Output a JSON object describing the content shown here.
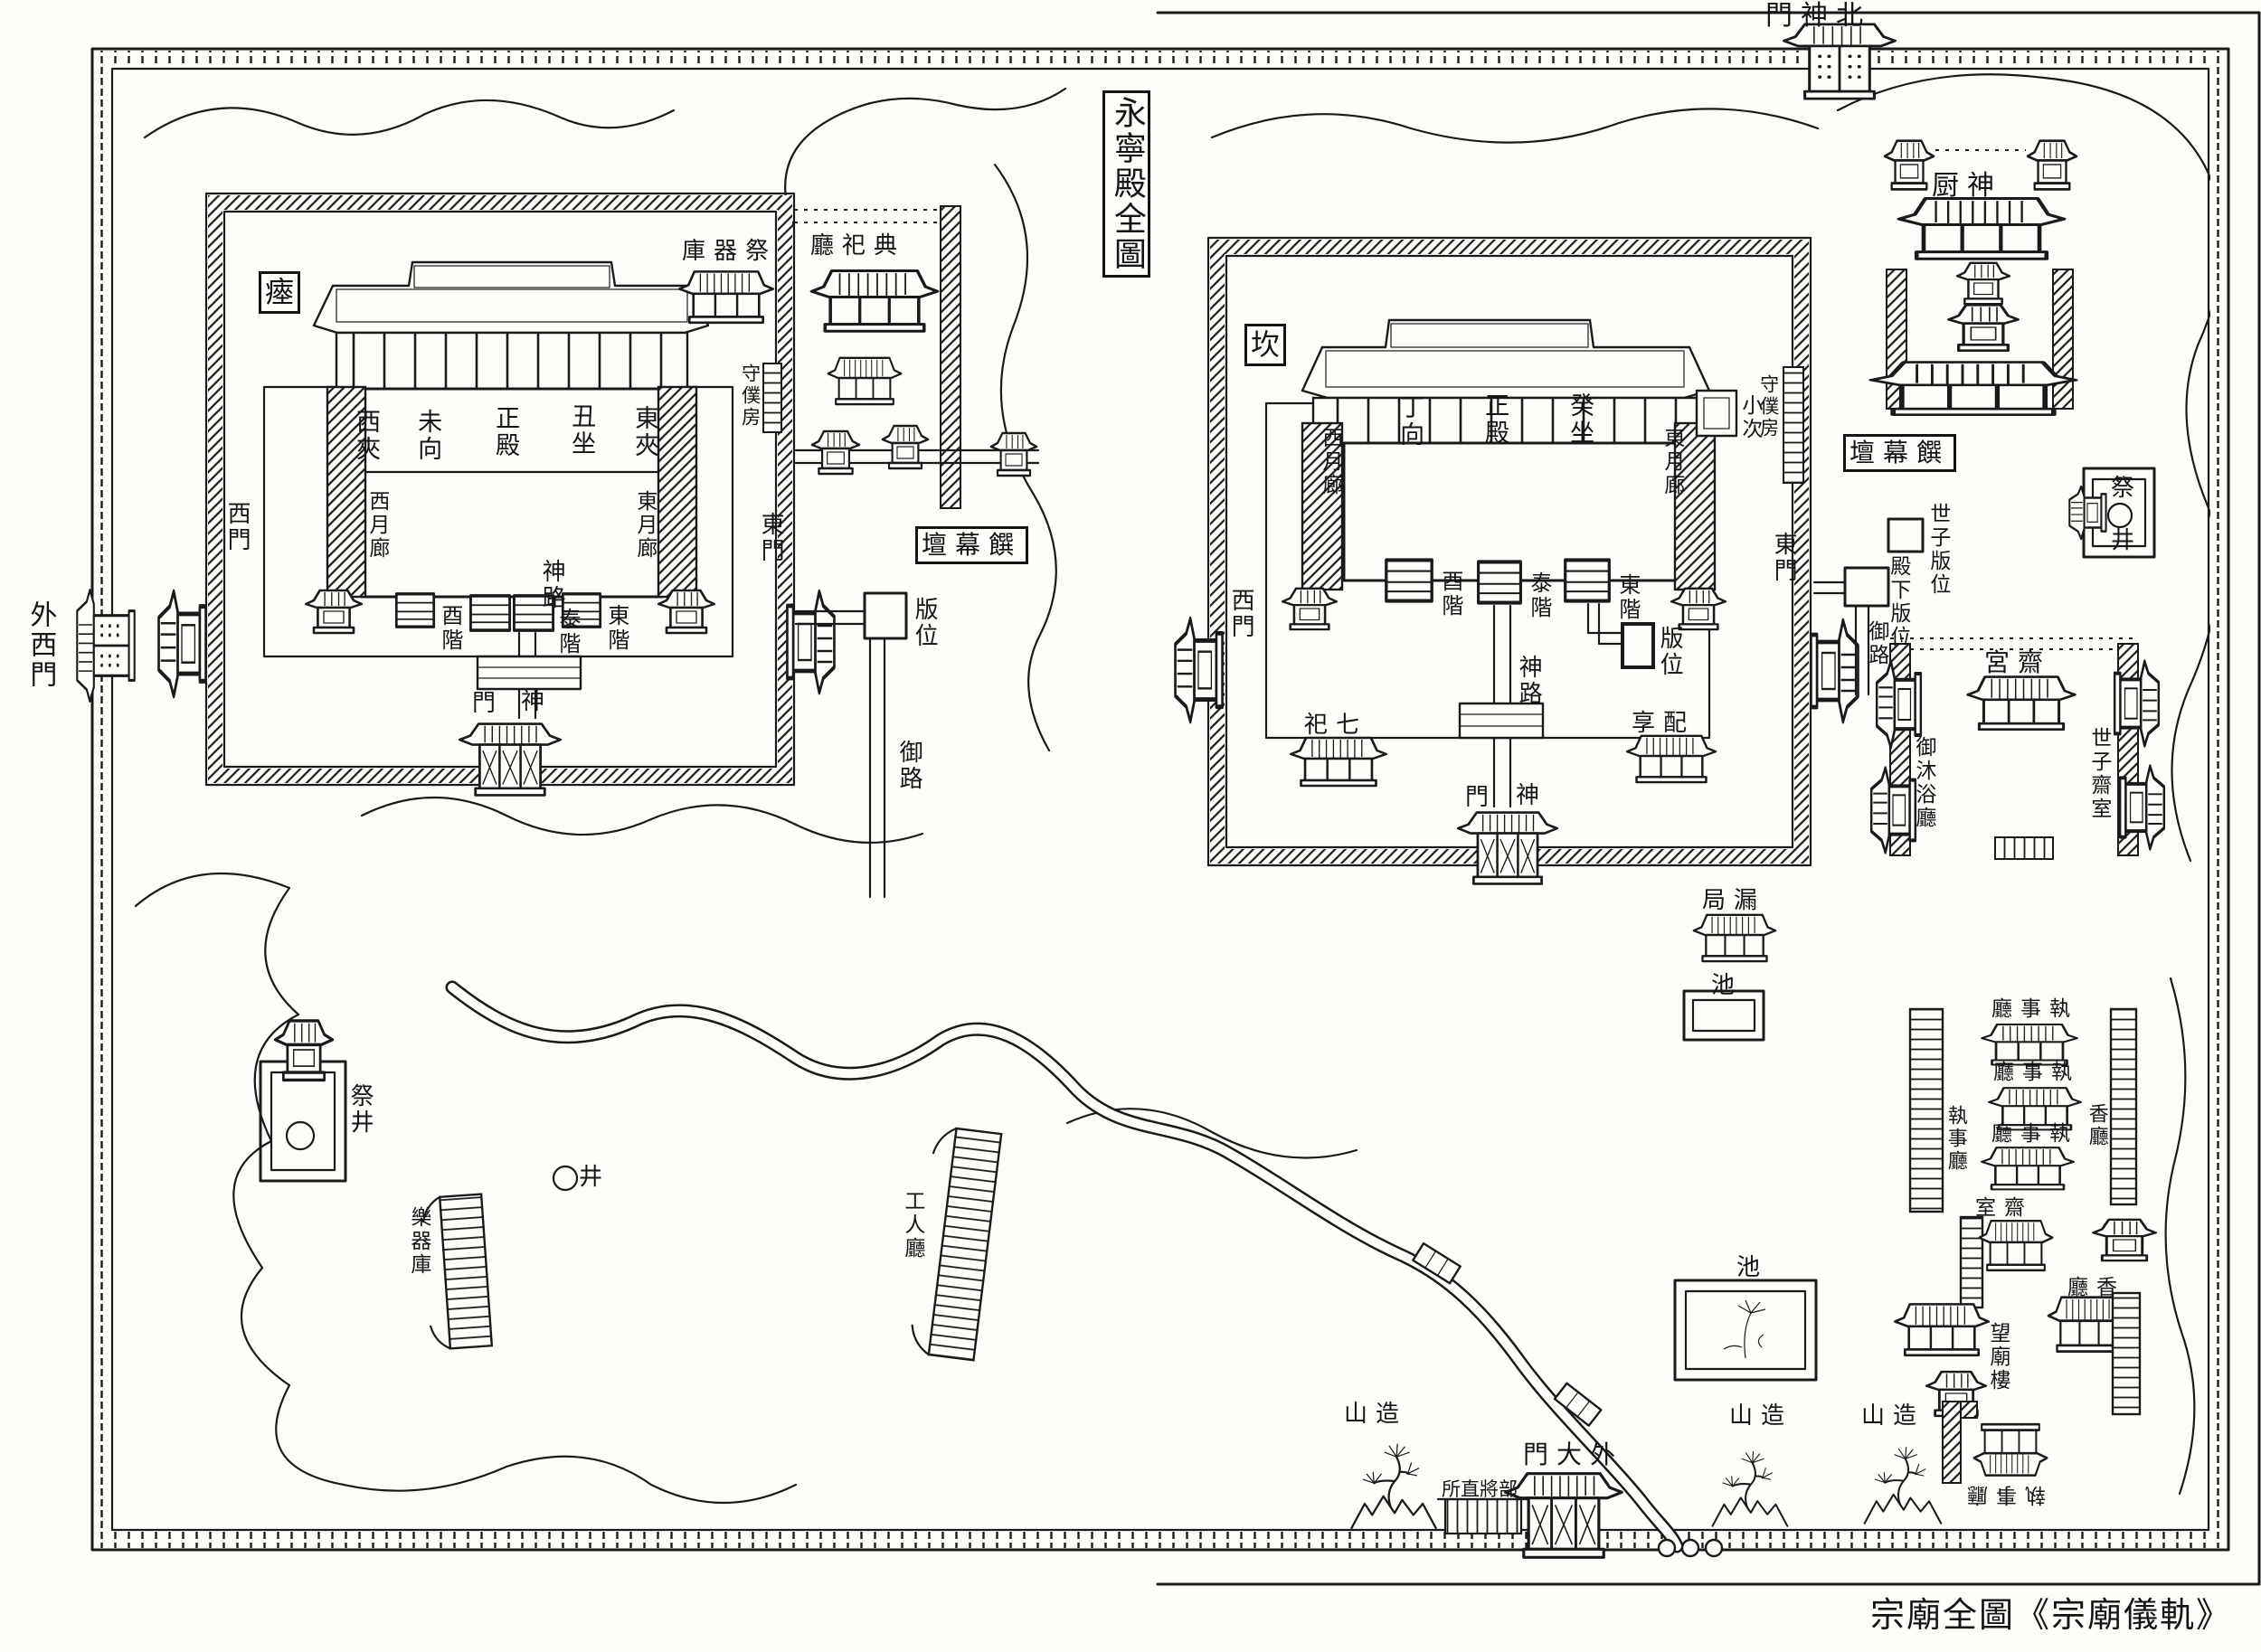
{
  "cartouche": "永寧殿全圖",
  "caption": "宗廟全圖《宗廟儀軌》",
  "outer": {
    "north_gate": "門神北",
    "west_gate": "外西門",
    "main_gate": "門大外",
    "guard_post": "所直將部",
    "mound_w": "山造",
    "mound_m": "山造",
    "mound_e": "山造"
  },
  "yeongnyeongjeon": {
    "pit": "瘞",
    "west_bay": "西夾",
    "facing": "未向",
    "main_hall": "正殿",
    "sitting": "丑坐",
    "east_bay": "東夾",
    "west_corridor": "西月廊",
    "east_corridor": "東月廊",
    "west_stair": "酉階",
    "grand_stair": "泰階",
    "east_stair": "東階",
    "spirit_road": "神路",
    "spirit_gate_left": "門",
    "spirit_gate_right": "神",
    "west_gate": "西門",
    "east_gate": "東門",
    "keeper_room": "守僕房",
    "vessel_store": "庫器祭",
    "ritual_office": "廳祀典",
    "offering_altar": "壇幕饌",
    "tablet_spot": "版位",
    "royal_road": "御路"
  },
  "jeongjeon": {
    "pit": "坎",
    "facing": "丁向",
    "main_hall": "正殿",
    "sitting": "癸坐",
    "west_corridor": "西月廊",
    "east_corridor": "東月廊",
    "small_tent": "小次",
    "keeper_room": "守僕房",
    "west_stair": "酉階",
    "grand_stair": "泰階",
    "east_stair": "東階",
    "tablet_spot": "版位",
    "spirit_road": "神路",
    "west_gate": "西門",
    "east_gate": "東門",
    "seven_shrines": "祀七",
    "merit_hall": "享配",
    "spirit_gate_left": "門",
    "spirit_gate_right": "神",
    "offering_altar": "壇幕饌",
    "crown_prince_spot": "世子版位",
    "king_spot": "殿下版位",
    "royal_road": "御路"
  },
  "east": {
    "sacred_kitchen": "厨神",
    "well_top": "祭",
    "well_bottom": "井",
    "palace": "宮齋",
    "royal_bath": "御沐浴廳",
    "crown_prince_chamber": "世子齋室",
    "clepsydra": "局漏",
    "pond_small": "池",
    "pond_large": "池"
  },
  "southeast": {
    "steward_hall_1": "廳事執",
    "steward_hall_2": "廳事執",
    "steward_hall_3": "廳事執",
    "steward_hall_west": "執事廳",
    "incense_hall_east": "香廳",
    "abstinence_room": "室齋",
    "shrine_view_pavilion": "望廟樓",
    "incense_hall": "廳香",
    "steward_hall_south": "執事廳"
  },
  "southwest": {
    "sacrificial_well": "祭井",
    "well": "井",
    "instrument_store": "樂器庫",
    "musicians_hall": "工人廳"
  }
}
